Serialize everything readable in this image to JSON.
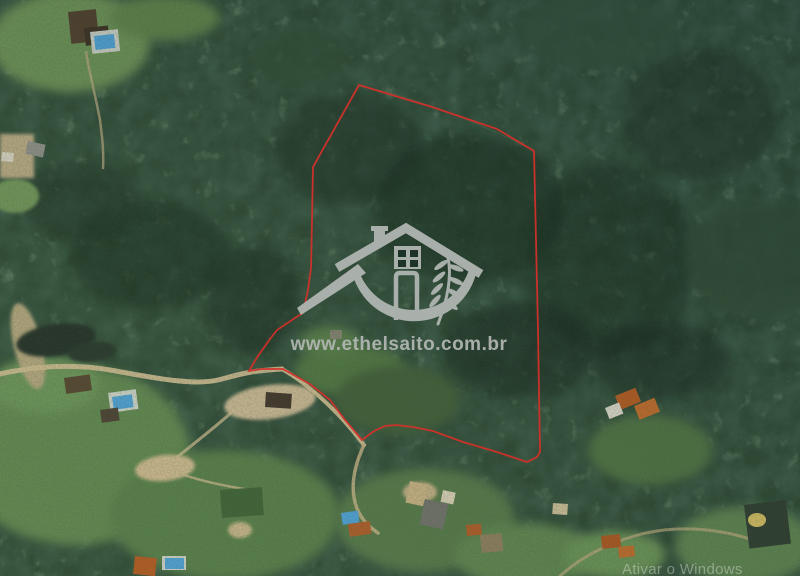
{
  "meta": {
    "description": "Satellite aerial photo of rural property with red boundary outline and realtor watermark"
  },
  "watermark": {
    "site_url": "www.ethelsaito.com.br",
    "logo_color": "#b0b5b1"
  },
  "os_watermark": {
    "text": "Ativar o Windows",
    "color": "rgba(238,243,243,0.38)"
  },
  "boundary": {
    "color": "#d2302a",
    "points": "359,85 432,107 497,129 534,151 536,240 538,330 540,452 537,457 527,462 497,452 463,442 433,431 413,427 396,425 385,426 374,431 362,440 345,420 330,400 310,384 283,369 262,369 249,371 258,356 270,339 277,330 295,318 303,313 308,290 311,268 312,220 313,167"
  },
  "map": {
    "palette": {
      "forest_base": "#2b4633",
      "forest_shadow": "#16281e",
      "grass": "#5f8550",
      "dirt_road": "#cdbb91",
      "pond_water": "#202e25",
      "pool_blue": "#4da0d8",
      "roof_orange": "#b4571f",
      "roof_dark": "#4e3c2c"
    },
    "features": [
      {
        "kind": "forest-shadow",
        "shape": "ellipse",
        "x": 150,
        "y": 255,
        "rx": 80,
        "ry": 55,
        "fill": "#17291e",
        "op": 0.5,
        "blur": 2
      },
      {
        "kind": "forest-shadow",
        "shape": "ellipse",
        "x": 350,
        "y": 150,
        "rx": 75,
        "ry": 55,
        "fill": "#1a2e22",
        "op": 0.5,
        "blur": 2
      },
      {
        "kind": "forest-shadow",
        "shape": "ellipse",
        "x": 470,
        "y": 210,
        "rx": 95,
        "ry": 75,
        "fill": "#16291e",
        "op": 0.55,
        "blur": 2
      },
      {
        "kind": "forest-shadow",
        "shape": "ellipse",
        "x": 610,
        "y": 260,
        "rx": 85,
        "ry": 95,
        "fill": "#17291e",
        "op": 0.5,
        "blur": 2
      },
      {
        "kind": "forest-shadow",
        "shape": "ellipse",
        "x": 700,
        "y": 115,
        "rx": 75,
        "ry": 65,
        "fill": "#1a2e22",
        "op": 0.45,
        "blur": 2
      },
      {
        "kind": "forest-shadow",
        "shape": "ellipse",
        "x": 520,
        "y": 350,
        "rx": 75,
        "ry": 48,
        "fill": "#15271d",
        "op": 0.55,
        "blur": 2
      },
      {
        "kind": "forest-shadow",
        "shape": "ellipse",
        "x": 255,
        "y": 300,
        "rx": 45,
        "ry": 55,
        "fill": "#15271d",
        "op": 0.5,
        "blur": 2
      },
      {
        "kind": "forest-shadow",
        "shape": "ellipse",
        "x": 80,
        "y": 200,
        "rx": 60,
        "ry": 40,
        "fill": "#1a2f23",
        "op": 0.45,
        "blur": 2
      },
      {
        "kind": "forest-shadow",
        "shape": "ellipse",
        "x": 660,
        "y": 360,
        "rx": 70,
        "ry": 40,
        "fill": "#15271d",
        "op": 0.5,
        "blur": 2
      },
      {
        "kind": "lawn",
        "shape": "ellipse",
        "x": 70,
        "y": 42,
        "rx": 80,
        "ry": 50,
        "fill": "#6a8f54",
        "blur": 2
      },
      {
        "kind": "lawn",
        "shape": "ellipse",
        "x": 165,
        "y": 18,
        "rx": 55,
        "ry": 22,
        "fill": "#5d8049",
        "blur": 2
      },
      {
        "kind": "field",
        "shape": "ellipse",
        "x": 15,
        "y": 196,
        "rx": 24,
        "ry": 17,
        "fill": "#6f9459",
        "blur": 1
      },
      {
        "kind": "lawn",
        "shape": "ellipse",
        "x": 75,
        "y": 455,
        "rx": 115,
        "ry": 90,
        "fill": "#5f8550",
        "blur": 2
      },
      {
        "kind": "lawn",
        "shape": "ellipse",
        "x": 225,
        "y": 515,
        "rx": 115,
        "ry": 65,
        "fill": "#577b4a",
        "blur": 2
      },
      {
        "kind": "lawn",
        "shape": "ellipse",
        "x": 45,
        "y": 385,
        "rx": 55,
        "ry": 28,
        "fill": "#6b9259",
        "blur": 2
      },
      {
        "kind": "clearing",
        "shape": "ellipse",
        "x": 350,
        "y": 370,
        "rx": 55,
        "ry": 26,
        "fill": "#507443",
        "blur": 2
      },
      {
        "kind": "clearing",
        "shape": "ellipse",
        "x": 398,
        "y": 400,
        "rx": 62,
        "ry": 34,
        "fill": "#405d38",
        "blur": 2
      },
      {
        "kind": "clearing",
        "shape": "ellipse",
        "x": 330,
        "y": 342,
        "rx": 30,
        "ry": 16,
        "fill": "#567b49",
        "blur": 2
      },
      {
        "kind": "lawn",
        "shape": "ellipse",
        "x": 425,
        "y": 520,
        "rx": 90,
        "ry": 52,
        "fill": "#54774a",
        "blur": 2
      },
      {
        "kind": "lawn",
        "shape": "ellipse",
        "x": 525,
        "y": 555,
        "rx": 70,
        "ry": 32,
        "fill": "#5d8350",
        "blur": 2
      },
      {
        "kind": "lawn",
        "shape": "ellipse",
        "x": 650,
        "y": 450,
        "rx": 62,
        "ry": 35,
        "fill": "#4d7142",
        "blur": 2
      },
      {
        "kind": "lawn",
        "shape": "ellipse",
        "x": 745,
        "y": 545,
        "rx": 70,
        "ry": 38,
        "fill": "#5b8150",
        "blur": 2
      },
      {
        "kind": "lawn",
        "shape": "ellipse",
        "x": 615,
        "y": 555,
        "rx": 50,
        "ry": 24,
        "fill": "#679055",
        "blur": 2
      },
      {
        "kind": "canopy-highlight",
        "shape": "ellipse",
        "x": 755,
        "y": 258,
        "rx": 70,
        "ry": 58,
        "fill": "#2e4a34",
        "op": 0.8,
        "blur": 2
      },
      {
        "kind": "canopy-highlight",
        "shape": "ellipse",
        "x": 600,
        "y": 30,
        "rx": 80,
        "ry": 38,
        "fill": "#31503a",
        "op": 0.75,
        "blur": 2
      },
      {
        "kind": "canopy-highlight",
        "shape": "ellipse",
        "x": 300,
        "y": 58,
        "rx": 48,
        "ry": 28,
        "fill": "#2f4c36",
        "op": 0.7,
        "blur": 2
      },
      {
        "kind": "pond-bank",
        "shape": "ellipse",
        "x": 28,
        "y": 346,
        "rx": 14,
        "ry": 44,
        "rot": -14,
        "fill": "#b3a47d",
        "blur": 1
      },
      {
        "kind": "pond",
        "shape": "ellipse",
        "x": 56,
        "y": 340,
        "rx": 40,
        "ry": 16,
        "rot": -8,
        "fill": "#202e25",
        "blur": 1
      },
      {
        "kind": "pond",
        "shape": "ellipse",
        "x": 92,
        "y": 352,
        "rx": 24,
        "ry": 10,
        "rot": -6,
        "fill": "#253429",
        "blur": 1
      },
      {
        "kind": "sand-patch",
        "shape": "rect",
        "x": 0,
        "y": 134,
        "w": 34,
        "h": 44,
        "fill": "#b9a884",
        "blur": 1
      },
      {
        "kind": "sand-patch",
        "shape": "ellipse",
        "x": 270,
        "y": 402,
        "rx": 46,
        "ry": 17,
        "rot": -7,
        "fill": "#cab794",
        "blur": 1
      },
      {
        "kind": "sand-patch",
        "shape": "ellipse",
        "x": 165,
        "y": 468,
        "rx": 30,
        "ry": 13,
        "rot": -6,
        "fill": "#ccb78e",
        "blur": 1
      },
      {
        "kind": "sand-patch",
        "shape": "ellipse",
        "x": 240,
        "y": 530,
        "rx": 12,
        "ry": 8,
        "fill": "#c7b489",
        "blur": 1
      },
      {
        "kind": "sand-patch",
        "shape": "ellipse",
        "x": 420,
        "y": 492,
        "rx": 17,
        "ry": 10,
        "fill": "#c2ad83",
        "blur": 1
      },
      {
        "kind": "dirt-road",
        "shape": "path",
        "d": "M0,374 C30,367 70,363 110,370 C150,377 192,386 218,380 C235,376 245,371 282,369",
        "stroke": "#cdbb91",
        "sw": 5,
        "op": 0.95
      },
      {
        "kind": "dirt-road",
        "shape": "path",
        "d": "M282,369 C305,382 332,406 352,430 C357,436 360,440 364,445",
        "stroke": "#c9b78e",
        "sw": 4
      },
      {
        "kind": "dirt-road",
        "shape": "path",
        "d": "M364,445 C356,462 350,482 355,502 C359,518 368,526 378,533",
        "stroke": "#c4b186",
        "sw": 3.5,
        "op": 0.85
      },
      {
        "kind": "trail",
        "shape": "path",
        "d": "M232,412 C212,430 188,448 170,463",
        "stroke": "#c8b58c",
        "sw": 3,
        "op": 0.8
      },
      {
        "kind": "trail",
        "shape": "path",
        "d": "M170,470 C198,481 228,487 258,491",
        "stroke": "#c8b58c",
        "sw": 2.5,
        "op": 0.8
      },
      {
        "kind": "driveway",
        "shape": "path",
        "d": "M86,52 C90,76 96,98 100,120 C102,136 104,152 103,168",
        "stroke": "#b7a57f",
        "sw": 2.5,
        "op": 0.75
      },
      {
        "kind": "dirt-road",
        "shape": "path",
        "d": "M560,576 C582,556 612,541 646,533 C682,525 722,529 756,541",
        "stroke": "#bca87e",
        "sw": 3,
        "op": 0.7
      },
      {
        "kind": "trail",
        "shape": "path",
        "d": "M359,86 C420,98 480,124 532,149",
        "stroke": "#49684a",
        "sw": 1.5,
        "op": 0.55
      },
      {
        "kind": "house-roof",
        "shape": "rect",
        "x": 68,
        "y": 12,
        "w": 28,
        "h": 32,
        "rot": -6,
        "fill": "#4e3c2c"
      },
      {
        "kind": "house-roof",
        "shape": "rect",
        "x": 84,
        "y": 28,
        "w": 24,
        "h": 18,
        "rot": -6,
        "fill": "#3a2d22"
      },
      {
        "kind": "pool-deck",
        "shape": "rect",
        "x": 90,
        "y": 32,
        "w": 28,
        "h": 22,
        "rot": -6,
        "fill": "#c9cec6"
      },
      {
        "kind": "pool",
        "shape": "rect",
        "x": 94,
        "y": 36,
        "w": 20,
        "h": 14,
        "rot": -6,
        "fill": "#4da0d8"
      },
      {
        "kind": "house-roof",
        "shape": "rect",
        "x": 28,
        "y": 141,
        "w": 18,
        "h": 13,
        "rot": 12,
        "fill": "#8f8f89"
      },
      {
        "kind": "structure",
        "shape": "rect",
        "x": 2,
        "y": 152,
        "w": 12,
        "h": 9,
        "rot": 5,
        "fill": "#d8d2c4"
      },
      {
        "kind": "house-roof",
        "shape": "rect",
        "x": 64,
        "y": 378,
        "w": 26,
        "h": 16,
        "rot": -8,
        "fill": "#54432f"
      },
      {
        "kind": "pool-deck",
        "shape": "rect",
        "x": 108,
        "y": 393,
        "w": 28,
        "h": 20,
        "rot": -8,
        "fill": "#cdd2c9"
      },
      {
        "kind": "pool",
        "shape": "rect",
        "x": 112,
        "y": 397,
        "w": 20,
        "h": 13,
        "rot": -8,
        "fill": "#4da0d8"
      },
      {
        "kind": "house-roof",
        "shape": "rect",
        "x": 100,
        "y": 410,
        "w": 18,
        "h": 13,
        "rot": -8,
        "fill": "#4a3f33"
      },
      {
        "kind": "shed",
        "shape": "rect",
        "x": 266,
        "y": 392,
        "w": 26,
        "h": 15,
        "rot": 4,
        "fill": "#41332a"
      },
      {
        "kind": "structure",
        "shape": "rect",
        "x": 330,
        "y": 330,
        "w": 12,
        "h": 9,
        "fill": "#8a8274",
        "op": 0.9
      },
      {
        "kind": "court",
        "shape": "rect",
        "x": 220,
        "y": 490,
        "w": 42,
        "h": 28,
        "rot": -4,
        "fill": "#3d6136"
      },
      {
        "kind": "house-roof",
        "shape": "rect",
        "x": 410,
        "y": 481,
        "w": 18,
        "h": 22,
        "rot": 12,
        "fill": "#c8b084"
      },
      {
        "kind": "house-roof",
        "shape": "rect",
        "x": 425,
        "y": 499,
        "w": 24,
        "h": 26,
        "rot": 12,
        "fill": "#70706a"
      },
      {
        "kind": "structure",
        "shape": "rect",
        "x": 443,
        "y": 490,
        "w": 13,
        "h": 12,
        "rot": 12,
        "fill": "#d9cfb6"
      },
      {
        "kind": "house-roof",
        "shape": "rect",
        "x": 466,
        "y": 525,
        "w": 15,
        "h": 11,
        "rot": -5,
        "fill": "#b05a26"
      },
      {
        "kind": "house-roof",
        "shape": "rect",
        "x": 480,
        "y": 535,
        "w": 22,
        "h": 18,
        "rot": -5,
        "fill": "#8d7d5e"
      },
      {
        "kind": "pool",
        "shape": "rect",
        "x": 341,
        "y": 513,
        "w": 17,
        "h": 12,
        "rot": -8,
        "fill": "#4da0d8"
      },
      {
        "kind": "house-roof",
        "shape": "rect",
        "x": 348,
        "y": 524,
        "w": 22,
        "h": 13,
        "rot": -8,
        "fill": "#ad5b28"
      },
      {
        "kind": "house-roof",
        "shape": "rect",
        "x": 135,
        "y": 556,
        "w": 22,
        "h": 18,
        "rot": 6,
        "fill": "#b4571f"
      },
      {
        "kind": "pool-deck",
        "shape": "rect",
        "x": 162,
        "y": 556,
        "w": 24,
        "h": 14,
        "fill": "#ccd1c8"
      },
      {
        "kind": "pool",
        "shape": "rect",
        "x": 165,
        "y": 558,
        "w": 19,
        "h": 11,
        "fill": "#4da0d8"
      },
      {
        "kind": "house-roof",
        "shape": "rect",
        "x": 615,
        "y": 396,
        "w": 22,
        "h": 15,
        "rot": -22,
        "fill": "#b45a20"
      },
      {
        "kind": "house-roof",
        "shape": "rect",
        "x": 634,
        "y": 406,
        "w": 22,
        "h": 15,
        "rot": -22,
        "fill": "#c26b2b"
      },
      {
        "kind": "structure",
        "shape": "rect",
        "x": 605,
        "y": 408,
        "w": 15,
        "h": 12,
        "rot": -22,
        "fill": "#ddd8cc"
      },
      {
        "kind": "house-roof",
        "shape": "rect",
        "x": 601,
        "y": 536,
        "w": 19,
        "h": 13,
        "rot": -6,
        "fill": "#ad5520"
      },
      {
        "kind": "house-roof",
        "shape": "rect",
        "x": 618,
        "y": 547,
        "w": 16,
        "h": 11,
        "rot": -6,
        "fill": "#c06a2a"
      },
      {
        "kind": "house-roof",
        "shape": "rect",
        "x": 553,
        "y": 503,
        "w": 15,
        "h": 11,
        "rot": 4,
        "fill": "#cdbd98"
      },
      {
        "kind": "fenced-plot",
        "shape": "rect",
        "x": 744,
        "y": 505,
        "w": 42,
        "h": 44,
        "rot": -7,
        "fill": "#2d3b2f"
      },
      {
        "kind": "sand-patch",
        "shape": "ellipse",
        "x": 757,
        "y": 520,
        "rx": 9,
        "ry": 7,
        "fill": "#d4bd62"
      }
    ]
  }
}
